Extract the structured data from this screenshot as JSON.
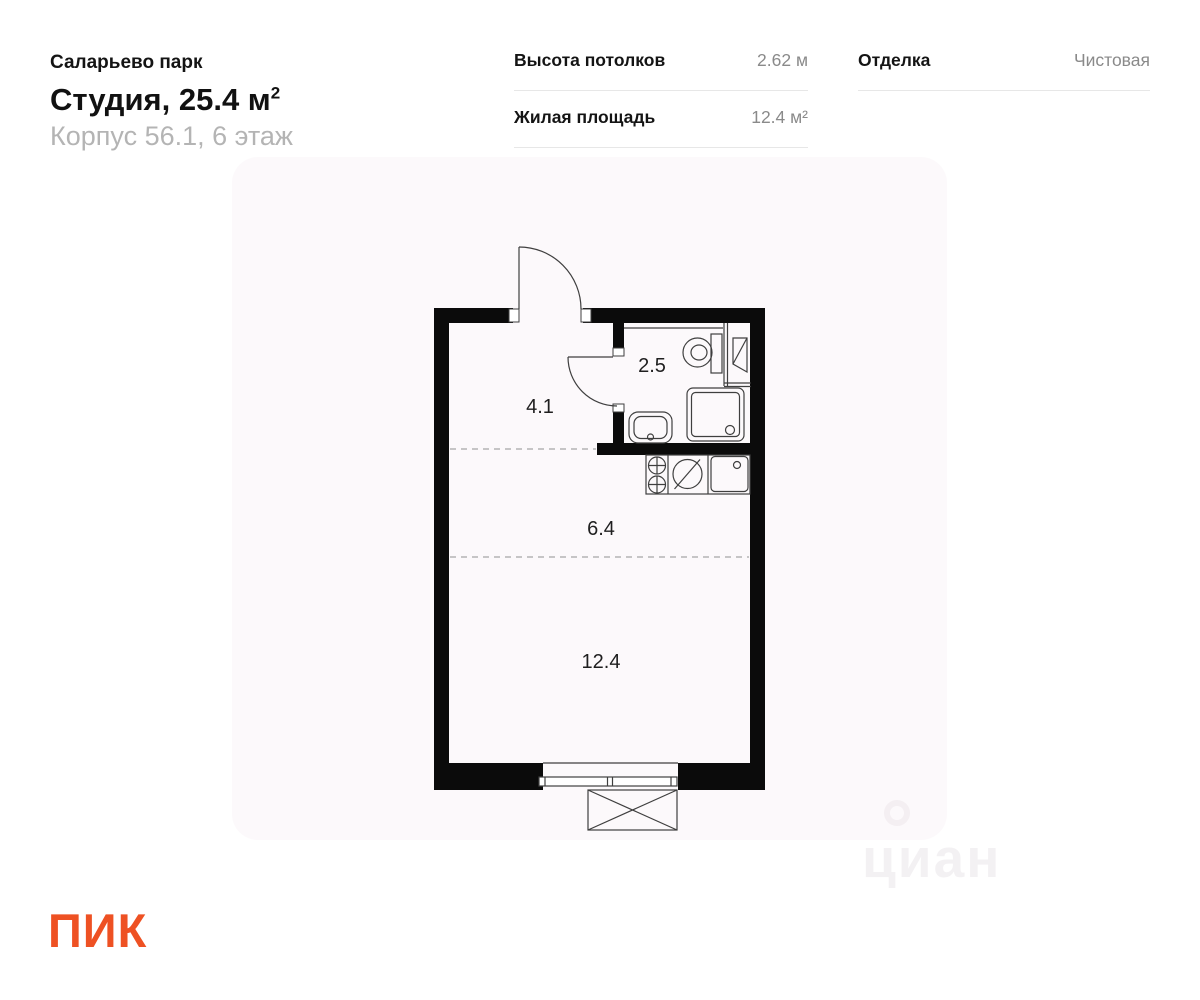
{
  "header": {
    "project": "Саларьево парк",
    "title": "Студия, 25.4 м",
    "title_sup": "2",
    "subtitle": "Корпус 56.1, 6 этаж"
  },
  "stats": {
    "col1": [
      {
        "label": "Высота потолков",
        "value": "2.62 м"
      },
      {
        "label": "Жилая площадь",
        "value": "12.4 м²"
      }
    ],
    "col2": [
      {
        "label": "Отделка",
        "value": "Чистовая"
      }
    ]
  },
  "plan": {
    "rooms": [
      {
        "name": "hallway",
        "area": "4.1"
      },
      {
        "name": "bathroom",
        "area": "2.5"
      },
      {
        "name": "kitchen",
        "area": "6.4"
      },
      {
        "name": "living-room",
        "area": "12.4"
      }
    ]
  },
  "watermark": {
    "text": "циан"
  },
  "brand": {
    "logo": "ПИК",
    "color": "#EE5123"
  }
}
